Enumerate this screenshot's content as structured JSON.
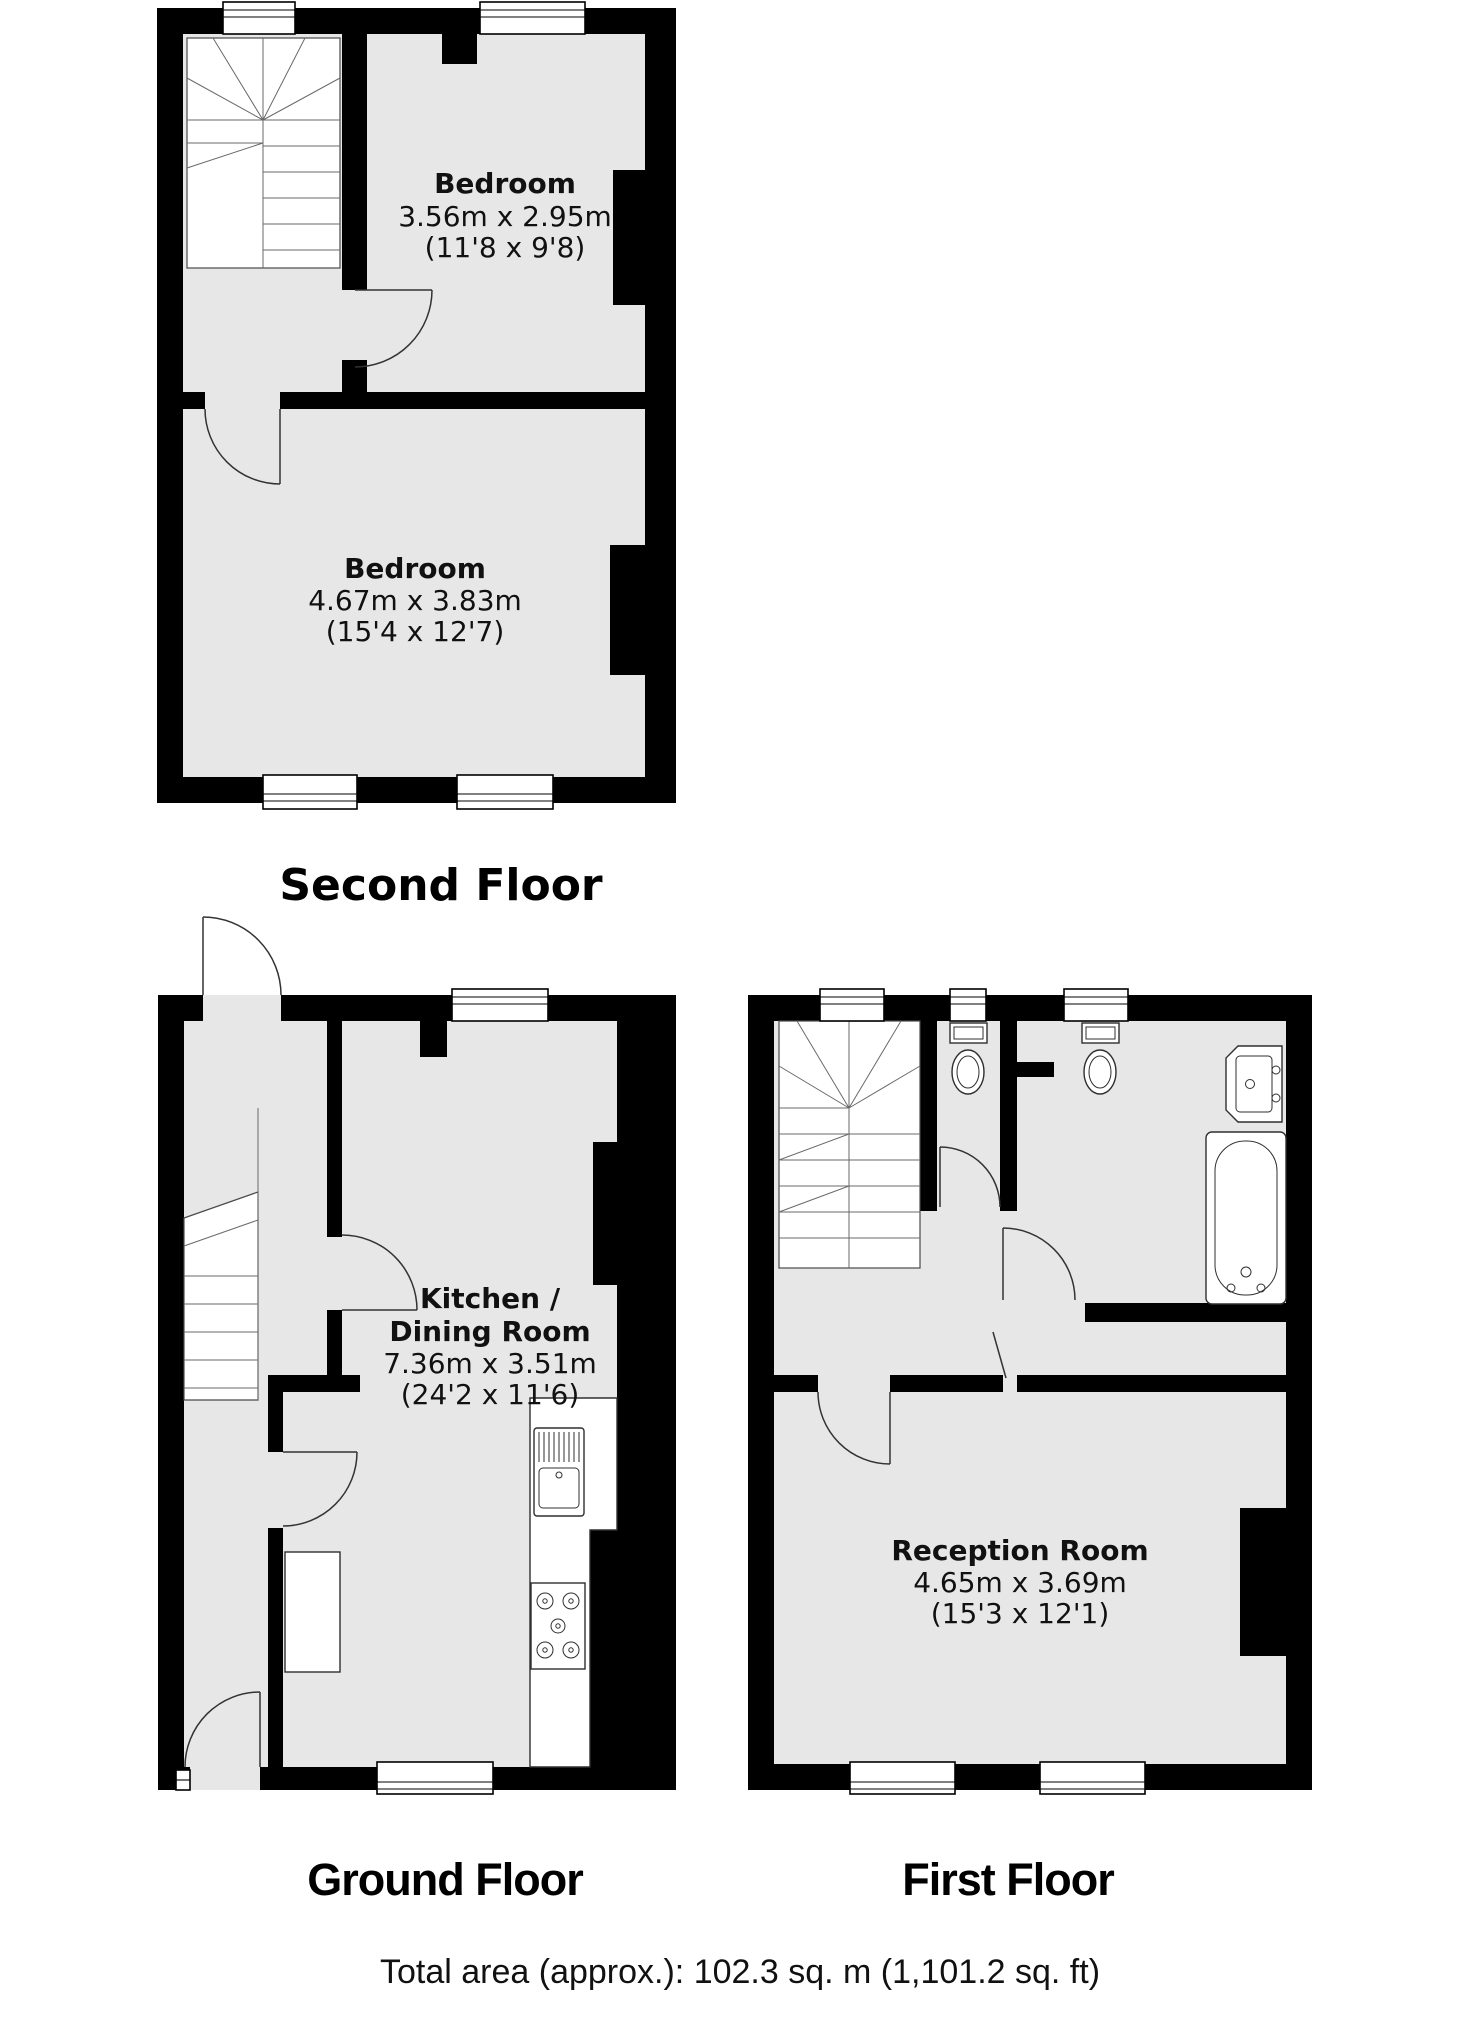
{
  "floors": [
    {
      "caption": "Second Floor",
      "rooms": [
        {
          "name": "Bedroom",
          "metric": "3.56m x 2.95m",
          "imperial": "(11'8 x 9'8)"
        },
        {
          "name": "Bedroom",
          "metric": "4.67m x 3.83m",
          "imperial": "(15'4 x 12'7)"
        }
      ]
    },
    {
      "caption": "Ground Floor",
      "rooms": [
        {
          "name_line1": "Kitchen /",
          "name_line2": "Dining Room",
          "metric": "7.36m x 3.51m",
          "imperial": "(24'2 x 11'6)"
        }
      ]
    },
    {
      "caption": "First Floor",
      "rooms": [
        {
          "name": "Reception Room",
          "metric": "4.65m x 3.69m",
          "imperial": "(15'3 x 12'1)"
        }
      ]
    }
  ],
  "footer": {
    "total_area": "Total area (approx.): 102.3 sq. m (1,101.2 sq. ft)"
  },
  "colors": {
    "wall": "#000000",
    "room_fill": "#e7e7e7",
    "background": "#ffffff"
  }
}
